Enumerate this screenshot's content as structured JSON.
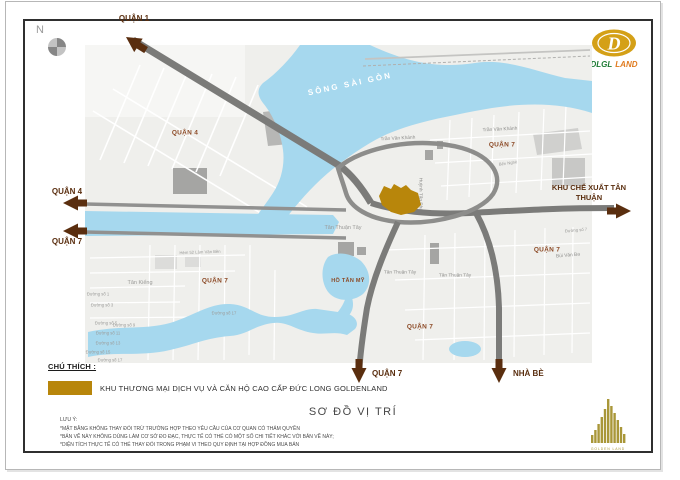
{
  "compass": {
    "n": "N"
  },
  "logo": {
    "monogram": "D",
    "brand_primary": "DLGL",
    "brand_secondary": "LAND",
    "gold": "#D4A017",
    "green": "#1E7B34",
    "orange": "#E07B1F"
  },
  "arrows": [
    {
      "label": "QUẬN 1"
    },
    {
      "label": "QUẬN 4"
    },
    {
      "label": "QUẬN 7"
    },
    {
      "label": "KHU CHẾ XUẤT TÂN THUẬN"
    },
    {
      "label": "QUẬN 7"
    },
    {
      "label": "NHÀ BÈ"
    }
  ],
  "map": {
    "colors": {
      "water": "#A6D8EE",
      "site_gold": "#B8860B",
      "road": "#7B7B79",
      "district_label_brown": "#8C4A26",
      "arrow_brown": "#5A2E0F"
    },
    "labels": [
      {
        "text": "QUẬN 4",
        "x": 100,
        "y": 88,
        "type": "district"
      },
      {
        "text": "QUẬN 7",
        "x": 417,
        "y": 100,
        "type": "district"
      },
      {
        "text": "QUẬN 7",
        "x": 130,
        "y": 236,
        "type": "district"
      },
      {
        "text": "QUẬN 7",
        "x": 462,
        "y": 205,
        "type": "district"
      },
      {
        "text": "QUẬN 7",
        "x": 335,
        "y": 282,
        "type": "district"
      },
      {
        "text": "HỒ TÂN MỸ",
        "x": 263,
        "y": 236,
        "type": "water"
      },
      {
        "text": "SÔNG SÀI GÒN",
        "x": 265,
        "y": 39,
        "type": "river",
        "rot": -12
      },
      {
        "text": "Trần Văn Khánh",
        "x": 313,
        "y": 94,
        "type": "street",
        "rot": -3
      },
      {
        "text": "Trần Văn Khánh",
        "x": 415,
        "y": 85,
        "type": "street",
        "rot": -3
      },
      {
        "text": "Tân Thuận Tây",
        "x": 258,
        "y": 183,
        "type": "place"
      },
      {
        "text": "Tân Thuận Tây",
        "x": 315,
        "y": 228,
        "type": "street"
      },
      {
        "text": "Tân Thuận Tây",
        "x": 370,
        "y": 231,
        "type": "street"
      },
      {
        "text": "Tân Kiểng",
        "x": 55,
        "y": 238,
        "type": "place"
      },
      {
        "text": "Bùi Văn Ba",
        "x": 483,
        "y": 211,
        "type": "street",
        "rot": -5
      },
      {
        "text": "Huỳnh Tấn Phát",
        "x": 335,
        "y": 150,
        "type": "street",
        "rot": 90
      },
      {
        "text": "Bến Nghé",
        "x": 423,
        "y": 118,
        "type": "streetxs",
        "rot": -8
      },
      {
        "text": "Hẻm 52 Lâm Văn Bền",
        "x": 115,
        "y": 207,
        "type": "streetxs",
        "rot": -2
      },
      {
        "text": "Đường số 1",
        "x": 13,
        "y": 249,
        "type": "streetxs"
      },
      {
        "text": "Đường số 3",
        "x": 17,
        "y": 260,
        "type": "streetxs"
      },
      {
        "text": "Đường số 5",
        "x": 21,
        "y": 278,
        "type": "streetxs"
      },
      {
        "text": "Đường số 9",
        "x": 39,
        "y": 280,
        "type": "streetxs"
      },
      {
        "text": "Đường số 11",
        "x": 23,
        "y": 288,
        "type": "streetxs"
      },
      {
        "text": "Đường số 13",
        "x": 23,
        "y": 298,
        "type": "streetxs"
      },
      {
        "text": "Đường số 15",
        "x": 13,
        "y": 307,
        "type": "streetxs"
      },
      {
        "text": "Đường số 17",
        "x": 25,
        "y": 315,
        "type": "streetxs"
      },
      {
        "text": "Đường số 17",
        "x": 139,
        "y": 268,
        "type": "streetxs"
      },
      {
        "text": "Đường số 7",
        "x": 491,
        "y": 185,
        "type": "streetxs",
        "rot": -5
      }
    ]
  },
  "legend": {
    "heading": "CHÚ THÍCH :",
    "swatch_color": "#B8860B",
    "item": "KHU THƯƠNG MẠI DỊCH VỤ VÀ CĂN HỘ CAO CẤP ĐỨC LONG GOLDENLAND"
  },
  "title": "SƠ ĐỒ VỊ TRÍ",
  "notes": {
    "heading": "LƯU Ý:",
    "items": [
      "*MẶT BẰNG KHÔNG THAY ĐỔI TRỪ TRƯỜNG HỢP THEO YÊU CẦU CỦA CƠ QUAN CÓ THẨM QUYỀN",
      "*BẢN VẼ NÀY KHÔNG DÙNG LÀM CƠ SỞ ĐO ĐẠC, THỰC TẾ CÓ THỂ CÓ MỘT SỐ CHI TIẾT KHÁC VỚI BẢN VẼ NÀY;",
      "*DIỆN TÍCH THỰC TẾ CÓ THỂ THAY ĐỔI TRONG PHẠM VI THEO QUY ĐỊNH TẠI HỢP ĐỒNG MUA BÁN"
    ]
  },
  "watermark": {
    "caption": "GOLDEN LAND"
  }
}
